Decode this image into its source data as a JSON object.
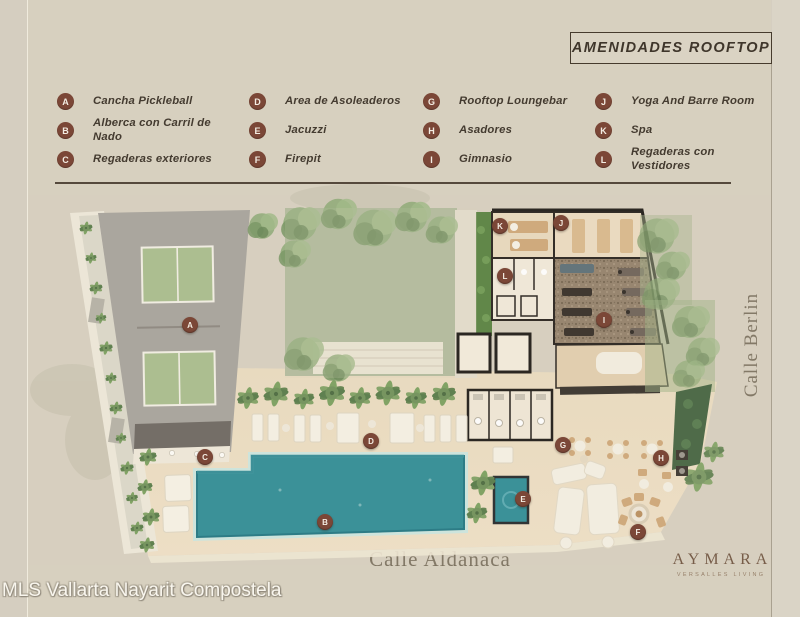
{
  "title": {
    "text": "AMENIDADES ROOFTOP"
  },
  "legend": {
    "items": [
      {
        "letter": "A",
        "label": "Cancha Pickleball"
      },
      {
        "letter": "B",
        "label": "Alberca con Carril de Nado"
      },
      {
        "letter": "C",
        "label": "Regaderas exteriores"
      },
      {
        "letter": "D",
        "label": "Area de Asoleaderos"
      },
      {
        "letter": "E",
        "label": "Jacuzzi"
      },
      {
        "letter": "F",
        "label": "Firepit"
      },
      {
        "letter": "G",
        "label": "Rooftop Loungebar"
      },
      {
        "letter": "H",
        "label": "Asadores"
      },
      {
        "letter": "I",
        "label": "Gimnasio"
      },
      {
        "letter": "J",
        "label": "Yoga And Barre Room"
      },
      {
        "letter": "K",
        "label": "Spa"
      },
      {
        "letter": "L",
        "label": "Regaderas con Vestidores"
      }
    ]
  },
  "streets": {
    "bottom": "Calle Aldanaca",
    "right": "Calle Berlin"
  },
  "brand": {
    "name": "AYMARA",
    "tagline": "VERSALLES LIVING"
  },
  "watermark": {
    "text": "MLS Vallarta Nayarit Compostela"
  },
  "colors": {
    "background": "#d5cec0",
    "marker": "#7b4737",
    "legend_text": "#443b30",
    "pool": "#2e8c95",
    "court_green": "#a9bd8c",
    "deck": "#ecdcc2",
    "garden_lawn": "#aab697",
    "street_text": "#7c7260",
    "brand_brown": "#6f543f"
  }
}
